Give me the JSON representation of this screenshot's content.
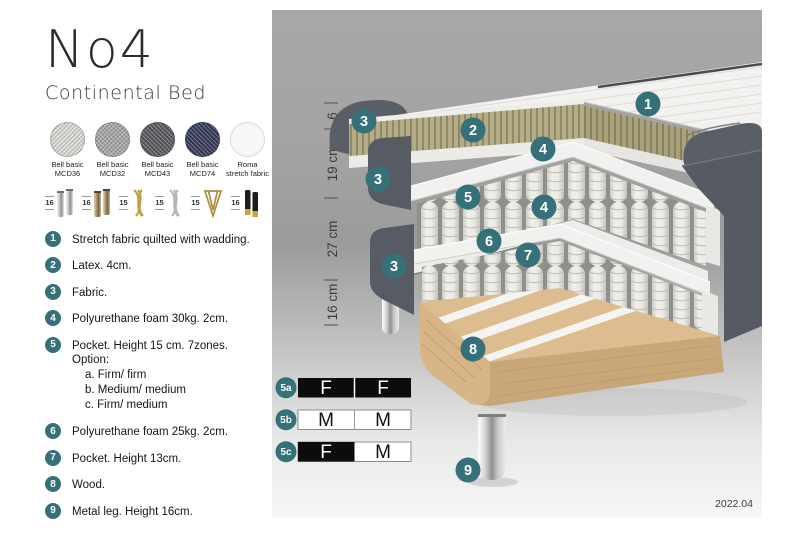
{
  "header": {
    "title": "No4",
    "subtitle": "Continental Bed"
  },
  "fabrics": [
    {
      "label": "Bell basic MCD36",
      "color": "#dddbd6"
    },
    {
      "label": "Bell basic MCD32",
      "color": "#a7a7a5"
    },
    {
      "label": "Bell basic MCD43",
      "color": "#595960"
    },
    {
      "label": "Bell basic MCD74",
      "color": "#343a57"
    },
    {
      "label": "Roma stretch fabric",
      "color": "#f7f7f7"
    }
  ],
  "legs": [
    {
      "height": "16",
      "name": "cylinder chrome"
    },
    {
      "height": "16",
      "name": "cylinder bronze"
    },
    {
      "height": "15",
      "name": "twisted gold"
    },
    {
      "height": "15",
      "name": "twisted silver"
    },
    {
      "height": "15",
      "name": "hairpin brass"
    },
    {
      "height": "16",
      "name": "black with gold foot"
    }
  ],
  "features": [
    {
      "num": "1",
      "text": "Stretch fabric quilted with wadding."
    },
    {
      "num": "2",
      "text": "Latex. 4cm."
    },
    {
      "num": "3",
      "text": "Fabric."
    },
    {
      "num": "4",
      "text": "Polyurethane foam 30kg. 2cm."
    },
    {
      "num": "5",
      "text": "Pocket. Height 15 cm. 7zones. Option:",
      "options": [
        "a. Firm/ firm",
        "b. Medium/ medium",
        "c. Firm/ medium"
      ]
    },
    {
      "num": "6",
      "text": "Polyurethane foam 25kg. 2cm."
    },
    {
      "num": "7",
      "text": "Pocket. Height 13cm."
    },
    {
      "num": "8",
      "text": "Wood."
    },
    {
      "num": "9",
      "text": "Metal leg. Height 16cm."
    }
  ],
  "diagram": {
    "measurements": [
      "6",
      "19 cm",
      "27 cm",
      "16 cm"
    ],
    "callouts": {
      "c1": "1",
      "c2": "2",
      "c3a": "3",
      "c3b": "3",
      "c3c": "3",
      "c4a": "4",
      "c4b": "4",
      "c5": "5",
      "c6": "6",
      "c7": "7",
      "c8": "8",
      "c9": "9"
    },
    "firmness": [
      {
        "id": "5a",
        "left": "F",
        "right": "F"
      },
      {
        "id": "5b",
        "left": "M",
        "right": "M"
      },
      {
        "id": "5c",
        "left": "F",
        "right": "M"
      }
    ],
    "version": "2022.04"
  },
  "colors": {
    "accent_teal": "#36717a",
    "fabric_dark": "#585d65",
    "latex": "#b4ad87",
    "wood": "#d7b586",
    "firm_cell": "#0c0c0c",
    "medium_cell": "#ffffff"
  }
}
